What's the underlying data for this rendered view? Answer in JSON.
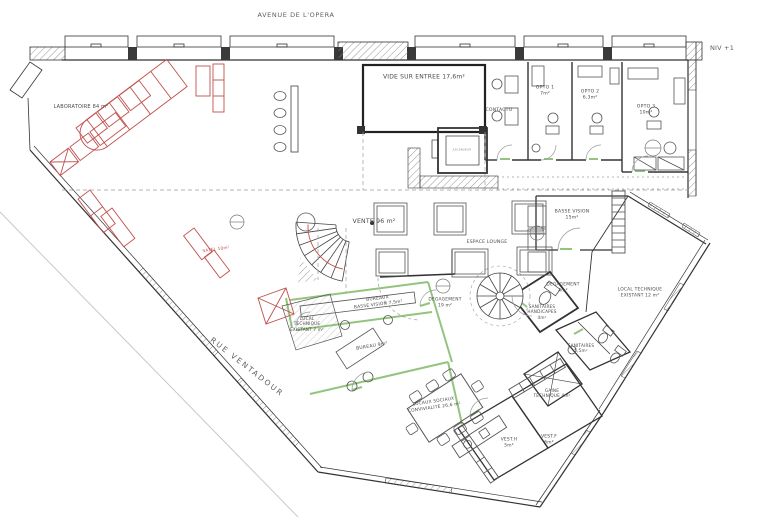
{
  "plan": {
    "level": "NIV +1",
    "street_top": "AVENUE DE L'OPERA",
    "street_left": "RUE VENTADOUR",
    "rooms": {
      "laboratoire": "LABORATOIRE 84 m²",
      "vide_entree": "VIDE SUR  ENTREE 17,6m²",
      "ascenseur": "ASCENSEUR",
      "contacto": "CONTACTO",
      "opto1": "OPTO 1\n7m²",
      "opto2": "OPTO 2\n6,3m²",
      "opto3": "OPTO 3\n10m²",
      "vente": "VENTE 96 m²",
      "espace_lounge": "ESPACE LOUNGE",
      "basse_vision": "BASSE VISION\n15m²",
      "degagement_4": "DEGAGEMENT\n4m²",
      "local_technique_12": "LOCAL TECHNIQUE\nEXISTANT 12 m²",
      "degagement_19": "DEGAGEMENT\n19 m²",
      "sanitaires_handicapes": "SANITAIRES\nHANDICAPES\n4m²",
      "sanitaires": "SANITAIRES\n5,5m²",
      "gaine_technique": "GAINE\nTECHNIQUE 4m²",
      "bureaux_basse_vision": "BUREAUX\nBASSE VISION 7,5m²",
      "local_technique_7": "LOCAL\nTECHNIQUE\nEXISTANT 7 m²",
      "bureau": "BUREAU 9m²",
      "locaux_sociaux": "LOCAUX SOCIAUX\nCONVIVIALITE 26,6 m²",
      "vest_h": "VEST.H\n5m²",
      "vest_f": "VEST.F\n6m²",
      "satel": "SATEL 10m²"
    },
    "colors": {
      "wall": "#333333",
      "equipment_red": "#c0504d",
      "partition_green": "#93c47d"
    }
  }
}
